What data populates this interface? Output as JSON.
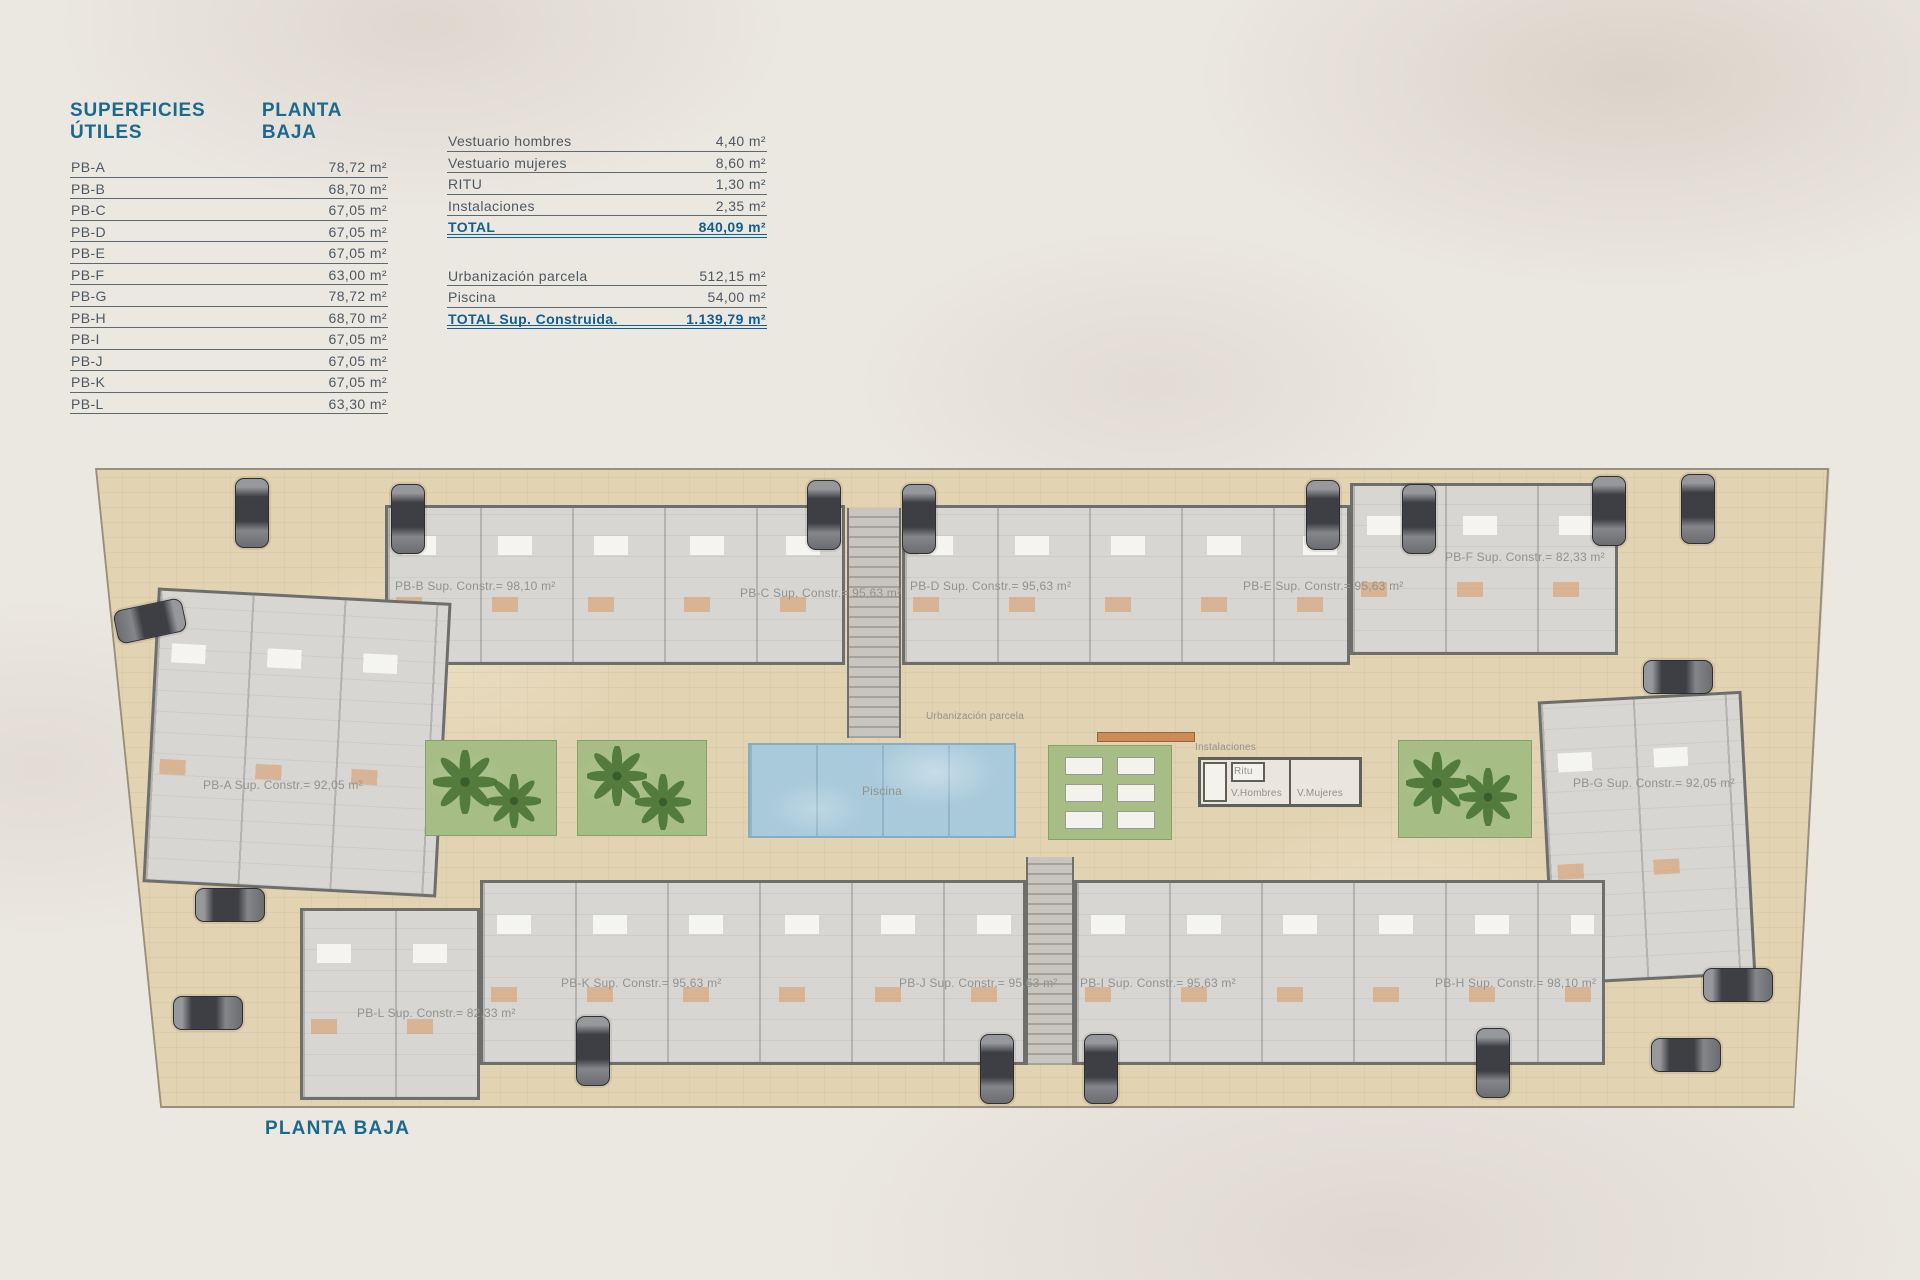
{
  "page": {
    "footer_title": "PLANTA BAJA"
  },
  "useful_areas": {
    "title": "SUPERFICIES ÚTILES",
    "subtitle": "PLANTA BAJA",
    "rows": [
      {
        "label": "PB-A",
        "value": "78,72 m²"
      },
      {
        "label": "PB-B",
        "value": "68,70 m²"
      },
      {
        "label": "PB-C",
        "value": "67,05 m²"
      },
      {
        "label": "PB-D",
        "value": "67,05 m²"
      },
      {
        "label": "PB-E",
        "value": "67,05 m²"
      },
      {
        "label": "PB-F",
        "value": "63,00 m²"
      },
      {
        "label": "PB-G",
        "value": "78,72 m²"
      },
      {
        "label": "PB-H",
        "value": "68,70 m²"
      },
      {
        "label": "PB-I",
        "value": "67,05 m²"
      },
      {
        "label": "PB-J",
        "value": "67,05 m²"
      },
      {
        "label": "PB-K",
        "value": "67,05 m²"
      },
      {
        "label": "PB-L",
        "value": "63,30 m²"
      }
    ]
  },
  "common_areas": {
    "rows": [
      {
        "label": "Vestuario hombres",
        "value": "4,40 m²"
      },
      {
        "label": "Vestuario mujeres",
        "value": "8,60 m²"
      },
      {
        "label": "RITU",
        "value": "1,30 m²"
      },
      {
        "label": "Instalaciones",
        "value": "2,35 m²"
      }
    ],
    "total": {
      "label": "TOTAL",
      "value": "840,09 m²"
    }
  },
  "site_areas": {
    "rows": [
      {
        "label": "Urbanización parcela",
        "value": "512,15 m²"
      },
      {
        "label": "Piscina",
        "value": "54,00 m²"
      }
    ],
    "total": {
      "label": "TOTAL Sup. Construida.",
      "value": "1.139,79 m²"
    }
  },
  "plan": {
    "units": [
      {
        "id": "PB-A",
        "label": "PB-A Sup. Constr.= 92,05 m²"
      },
      {
        "id": "PB-B",
        "label": "PB-B Sup. Constr.= 98,10 m²"
      },
      {
        "id": "PB-C",
        "label": "PB-C Sup. Constr.= 95,63 m²"
      },
      {
        "id": "PB-D",
        "label": "PB-D Sup. Constr.= 95,63 m²"
      },
      {
        "id": "PB-E",
        "label": "PB-E Sup. Constr.= 95,63 m²"
      },
      {
        "id": "PB-F",
        "label": "PB-F Sup. Constr.= 82,33 m²"
      },
      {
        "id": "PB-G",
        "label": "PB-G Sup. Constr.= 92,05 m²"
      },
      {
        "id": "PB-H",
        "label": "PB-H Sup. Constr.= 98,10 m²"
      },
      {
        "id": "PB-I",
        "label": "PB-I Sup. Constr.= 95,63 m²"
      },
      {
        "id": "PB-J",
        "label": "PB-J Sup. Constr.= 95,63 m²"
      },
      {
        "id": "PB-K",
        "label": "PB-K Sup. Constr.= 95,63 m²"
      },
      {
        "id": "PB-L",
        "label": "PB-L Sup. Constr.= 82,33 m²"
      }
    ],
    "labels": {
      "urbanizacion": "Urbanización parcela",
      "piscina": "Piscina",
      "instalaciones": "Instalaciones",
      "ritu": "Ritu",
      "v_hombres": "V.Hombres",
      "v_mujeres": "V.Mujeres"
    }
  },
  "colors": {
    "accent_teal": "#1b6a8e",
    "table_text": "#4e5864",
    "paving": "#e2d3b2",
    "pool_blue": "#a9cada",
    "garden_green": "#a6bd85",
    "unit_gray": "#d7d6d2"
  }
}
